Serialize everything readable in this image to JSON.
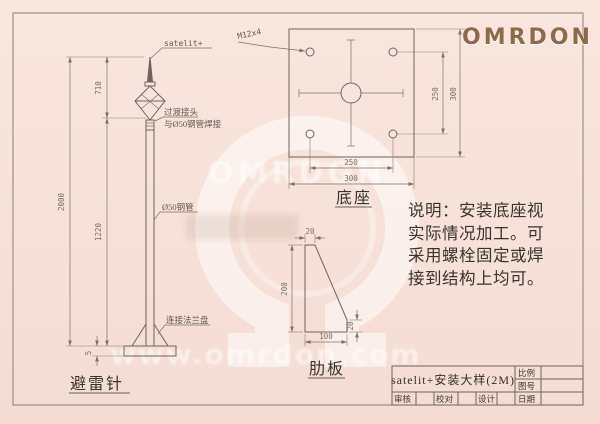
{
  "colors": {
    "background": "#f7e1d9",
    "line": "#6e635b",
    "brand": "#8d6a4a",
    "ink": "#3a342f",
    "watermark": "#ffffff"
  },
  "logo": {
    "text": "OMRDON"
  },
  "watermark": {
    "brand": "OMRDON",
    "url": "www.omrdon.com"
  },
  "lightning_rod": {
    "title": "避雷针",
    "tip_label": "satelit+",
    "joint_label_line1": "过渡接头",
    "joint_label_line2": "与Ø50钢管焊接",
    "pipe_label": "Ø50钢管",
    "flange_label": "连接法兰盘",
    "dim_total": "2000",
    "dim_upper": "710",
    "dim_lower": "1220",
    "dim_plate": "5"
  },
  "base_plate": {
    "title": "底座",
    "hole_label": "M12x4",
    "dim_hole_spacing_v": "250",
    "dim_side_v": "300",
    "dim_hole_spacing_h": "250",
    "dim_side_h": "300"
  },
  "rib_plate": {
    "title": "肋板",
    "dim_top": "20",
    "dim_height": "200",
    "dim_bottom": "100",
    "dim_right": "20"
  },
  "note": {
    "lines": [
      "说明：安装底座视",
      "实际情况加工。可",
      "采用螺栓固定或焊",
      "接到结构上均可。"
    ]
  },
  "title_block": {
    "drawing_title": "satelit+安装大样(2M)",
    "scale_label": "比例",
    "drawing_no_label": "图号",
    "date_label": "日期",
    "reviewer_label": "审核",
    "checker_label": "校对",
    "designer_label": "设计"
  }
}
